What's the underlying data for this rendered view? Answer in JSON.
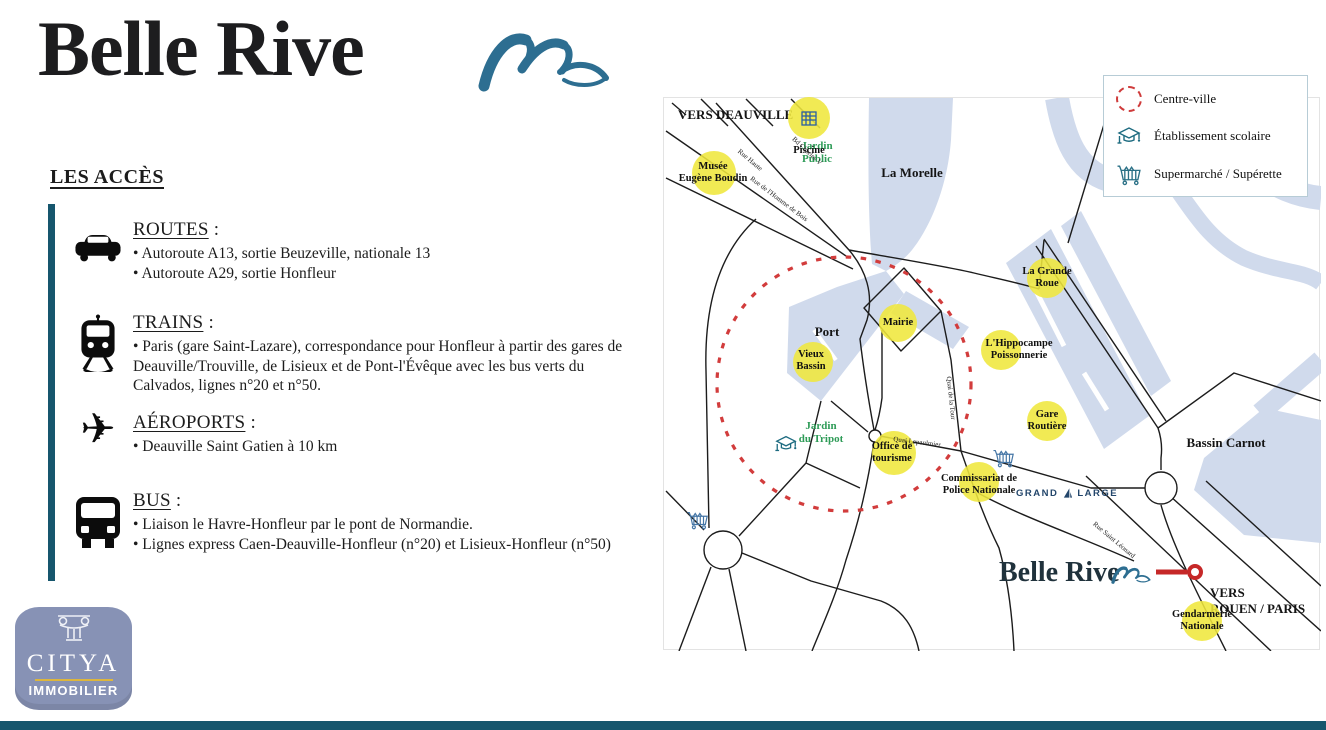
{
  "brand": {
    "name": "Belle Rive"
  },
  "access": {
    "heading": "LES ACCÈS",
    "sections": [
      {
        "icon": "car-icon",
        "title": "ROUTES",
        "suffix": " :",
        "bullets": [
          "• Autoroute A13, sortie Beuzeville, nationale 13",
          "• Autoroute A29, sortie Honfleur"
        ]
      },
      {
        "icon": "train-icon",
        "title": "TRAINS",
        "suffix": " :",
        "bullets": [
          "• Paris (gare Saint-Lazare), correspondance pour Honfleur à partir des gares de Deauville/Trouville, de Lisieux et de Pont-l'Évêque avec les bus verts du Calvados, lignes n°20 et n°50."
        ]
      },
      {
        "icon": "plane-icon",
        "title": "AÉROPORTS",
        "suffix": " :",
        "bullets": [
          "• Deauville Saint Gatien à 10 km"
        ]
      },
      {
        "icon": "bus-icon",
        "title": "BUS",
        "suffix": " :",
        "bullets": [
          "• Liaison le Havre-Honfleur par le pont de Normandie.",
          "• Lignes express Caen-Deauville-Honfleur (n°20) et Lisieux-Honfleur (n°50)"
        ]
      }
    ]
  },
  "citya": {
    "name": "CITYA",
    "subtitle": "IMMOBILIER"
  },
  "legend": {
    "items": [
      {
        "icon": "dotted-circle-icon",
        "label": "Centre-ville"
      },
      {
        "icon": "school-icon",
        "label": "Établissement scolaire"
      },
      {
        "icon": "cart-icon",
        "label": "Supermarché / Supérette"
      }
    ]
  },
  "map": {
    "direction_labels": {
      "deauville": "VERS DEAUVILLE",
      "rouen": "VERS\nROUEN / PARIS"
    },
    "water_labels": {
      "la_morelle": "La Morelle",
      "port": "Port",
      "bassin_carnot": "Bassin Carnot"
    },
    "green_labels": {
      "jardin_public": "Jardin\nPublic",
      "jardin_du_tripot": "Jardin\ndu Tripot"
    },
    "pois": [
      {
        "label": "Piscine"
      },
      {
        "label": "Musée\nEugène Boudin"
      },
      {
        "label": "La Grande\nRoue"
      },
      {
        "label": "Mairie"
      },
      {
        "label": "Vieux\nBassin"
      },
      {
        "label": "L'Hippocampe\nPoissonnerie"
      },
      {
        "label": "Gare\nRoutière"
      },
      {
        "label": "Office de\ntourisme"
      },
      {
        "label": "Commissariat de\nPolice Nationale"
      },
      {
        "label": "Gendarmerie\nNationale"
      }
    ],
    "roads": [
      "Bd Charles V",
      "Rue Haute",
      "Rue de l'Homme de Bois",
      "Quai de la Tour",
      "Quai Lepaulmier",
      "Rue Saint Léonard"
    ],
    "grand_large": {
      "word1": "GRAND",
      "word2": "LARGE"
    },
    "property_marker": {
      "label": "Belle Rive"
    },
    "colors": {
      "water": "#d0daec",
      "poi_yellow": "#efe73c",
      "centre_ville_red": "#cf3b3b",
      "accent_teal": "#16566d",
      "wave_blue": "#2d6e91",
      "green_label": "#2e9b57"
    }
  }
}
